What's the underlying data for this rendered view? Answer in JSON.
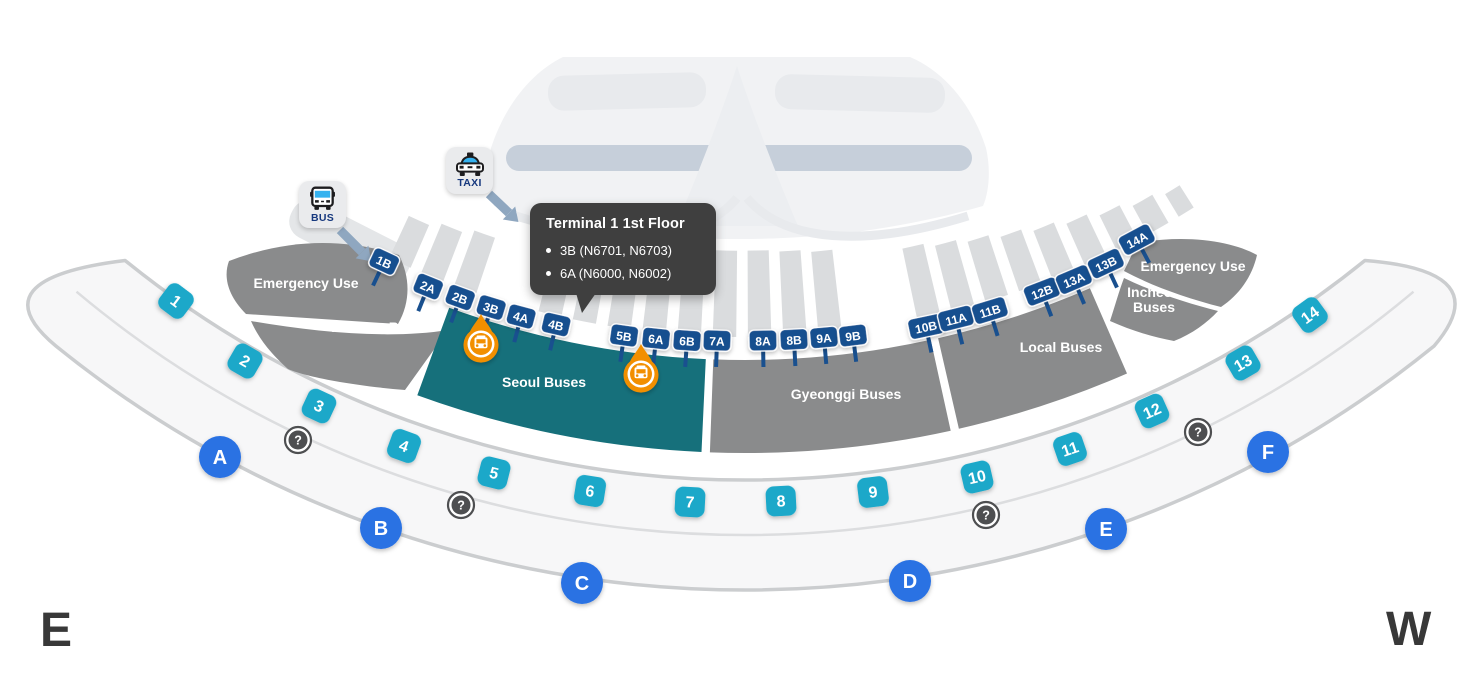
{
  "compass": {
    "east": "E",
    "west": "W"
  },
  "legend": {
    "bus": {
      "label": "BUS"
    },
    "taxi": {
      "label": "TAXI"
    }
  },
  "tooltip": {
    "title": "Terminal 1 1st Floor",
    "items": [
      "3B (N6701, N6703)",
      "6A (N6000, N6002)"
    ]
  },
  "colors": {
    "section_gray": "#8A8B8C",
    "section_teal": "#16707B",
    "stop_sign_navy": "#19508F",
    "gate_cyan": "#1EA8C9",
    "door_blue": "#2B72E3",
    "info_gray": "#4E4F51",
    "marker_orange": "#F28F00",
    "strip_gray": "#DADCDE",
    "island_fill": "#F7F7F8",
    "island_border": "#CBCDCF",
    "terminal_body": "#F1F2F4",
    "terminal_detail": "#E8EAED",
    "terminal_band": "#C6CFDA",
    "arrow_bluegray": "#8FA7C0",
    "tooltip_bg": "#3F3F3F"
  },
  "sections": [
    {
      "key": "left_emergency",
      "label": "Emergency Use",
      "lx": 306,
      "ly": 283
    },
    {
      "key": "left_incheon",
      "label": "Incheon Buses",
      "lx": 381,
      "ly": 327
    },
    {
      "key": "seoul",
      "label": "Seoul Buses",
      "lx": 544,
      "ly": 382,
      "t1": -20,
      "t2": -2.6,
      "teal": true
    },
    {
      "key": "gyeonggi",
      "label": "Gyeonggi Buses",
      "lx": 846,
      "ly": 394,
      "t1": -2.1,
      "t2": 12.4
    },
    {
      "key": "local",
      "label": "Local Buses",
      "lx": 1061,
      "ly": 347,
      "t1": 12.9,
      "t2": 23.5
    },
    {
      "key": "right_incheon",
      "label_lines": [
        "Incheon",
        "Buses"
      ],
      "lx": 1154,
      "ly": 295
    },
    {
      "key": "right_emergency",
      "label": "Emergency Use",
      "lx": 1193,
      "ly": 266
    }
  ],
  "stops": [
    {
      "id": "1B",
      "x": 384,
      "y": 262,
      "rot": 25
    },
    {
      "id": "2A",
      "x": 428,
      "y": 287,
      "rot": 22
    },
    {
      "id": "2B",
      "x": 460,
      "y": 298,
      "rot": 20
    },
    {
      "id": "3B",
      "x": 491,
      "y": 308,
      "rot": 17
    },
    {
      "id": "4A",
      "x": 521,
      "y": 317,
      "rot": 15
    },
    {
      "id": "4B",
      "x": 556,
      "y": 325,
      "rot": 13
    },
    {
      "id": "5B",
      "x": 624,
      "y": 336,
      "rot": 8
    },
    {
      "id": "6A",
      "x": 656,
      "y": 339,
      "rot": 6
    },
    {
      "id": "6B",
      "x": 687,
      "y": 341,
      "rot": 4
    },
    {
      "id": "7A",
      "x": 717,
      "y": 341,
      "rot": 2
    },
    {
      "id": "8A",
      "x": 763,
      "y": 341,
      "rot": -1
    },
    {
      "id": "8B",
      "x": 794,
      "y": 340,
      "rot": -3
    },
    {
      "id": "9A",
      "x": 824,
      "y": 338,
      "rot": -5
    },
    {
      "id": "9B",
      "x": 853,
      "y": 336,
      "rot": -7
    },
    {
      "id": "10B",
      "x": 926,
      "y": 327,
      "rot": -12
    },
    {
      "id": "11A",
      "x": 956,
      "y": 319,
      "rot": -14
    },
    {
      "id": "11B",
      "x": 990,
      "y": 311,
      "rot": -17
    },
    {
      "id": "12B",
      "x": 1042,
      "y": 292,
      "rot": -21
    },
    {
      "id": "13A",
      "x": 1074,
      "y": 280,
      "rot": -23
    },
    {
      "id": "13B",
      "x": 1106,
      "y": 264,
      "rot": -25
    },
    {
      "id": "14A",
      "x": 1137,
      "y": 240,
      "rot": -28
    }
  ],
  "gates": [
    {
      "n": "1",
      "x": 176,
      "y": 301,
      "rot": 37
    },
    {
      "n": "2",
      "x": 245,
      "y": 361,
      "rot": 30
    },
    {
      "n": "3",
      "x": 319,
      "y": 406,
      "rot": 25
    },
    {
      "n": "4",
      "x": 404,
      "y": 446,
      "rot": 20
    },
    {
      "n": "5",
      "x": 494,
      "y": 473,
      "rot": 14
    },
    {
      "n": "6",
      "x": 590,
      "y": 491,
      "rot": 9
    },
    {
      "n": "7",
      "x": 690,
      "y": 502,
      "rot": 3
    },
    {
      "n": "8",
      "x": 781,
      "y": 501,
      "rot": -3
    },
    {
      "n": "9",
      "x": 873,
      "y": 492,
      "rot": -7
    },
    {
      "n": "10",
      "x": 977,
      "y": 477,
      "rot": -13
    },
    {
      "n": "11",
      "x": 1070,
      "y": 449,
      "rot": -19
    },
    {
      "n": "12",
      "x": 1152,
      "y": 411,
      "rot": -24
    },
    {
      "n": "13",
      "x": 1243,
      "y": 363,
      "rot": -30
    },
    {
      "n": "14",
      "x": 1310,
      "y": 315,
      "rot": -36
    }
  ],
  "doors": [
    {
      "id": "A",
      "x": 220,
      "y": 457
    },
    {
      "id": "B",
      "x": 381,
      "y": 528
    },
    {
      "id": "C",
      "x": 582,
      "y": 583
    },
    {
      "id": "D",
      "x": 910,
      "y": 581
    },
    {
      "id": "E",
      "x": 1106,
      "y": 529
    },
    {
      "id": "F",
      "x": 1268,
      "y": 452
    }
  ],
  "info_points": [
    {
      "x": 298,
      "y": 440
    },
    {
      "x": 461,
      "y": 505
    },
    {
      "x": 986,
      "y": 515
    },
    {
      "x": 1198,
      "y": 432
    }
  ],
  "markers": [
    {
      "x": 481,
      "y": 344,
      "stop": "3B"
    },
    {
      "x": 641,
      "y": 374,
      "stop": "6A"
    }
  ]
}
